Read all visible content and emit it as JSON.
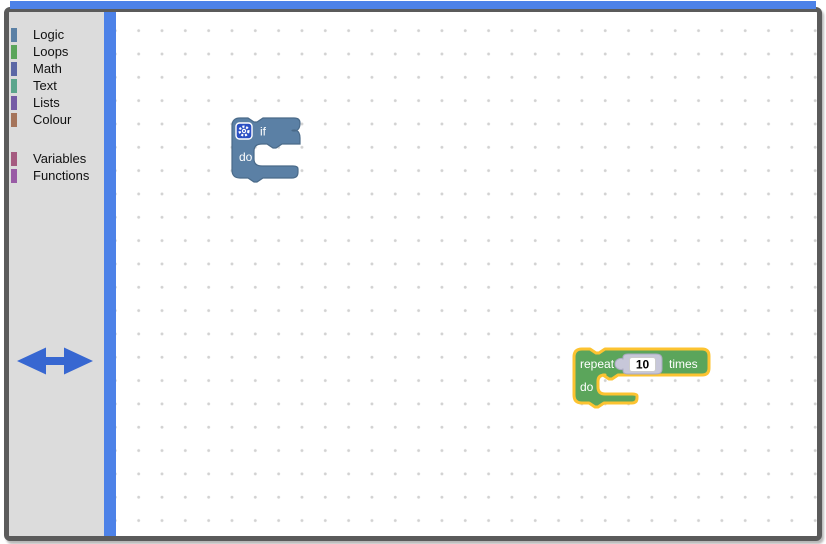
{
  "chrome": {
    "accent_blue": "#4d82e8",
    "frame_color": "#5b5b5b",
    "toolbox_bg": "#dcdcdc"
  },
  "toolbox": {
    "groups": [
      {
        "items": [
          {
            "label": "Logic",
            "color": "#5b80a5"
          },
          {
            "label": "Loops",
            "color": "#5ba55b"
          },
          {
            "label": "Math",
            "color": "#5b67a5"
          },
          {
            "label": "Text",
            "color": "#5ba58c"
          },
          {
            "label": "Lists",
            "color": "#745ba5"
          },
          {
            "label": "Colour",
            "color": "#a5745b"
          }
        ]
      },
      {
        "items": [
          {
            "label": "Variables",
            "color": "#a55b80"
          },
          {
            "label": "Functions",
            "color": "#995ba5"
          }
        ]
      }
    ]
  },
  "workspace": {
    "if_block": {
      "type": "controls_if",
      "label_if": "if",
      "label_do": "do",
      "color": "#5b80a5",
      "border_color": "#4a6a89",
      "gear_color": "#2b50c4"
    },
    "repeat_block": {
      "type": "controls_repeat",
      "label_repeat": "repeat",
      "label_times": "times",
      "label_do": "do",
      "value": "10",
      "color": "#5ba55b",
      "border_color": "#4a8a4a",
      "selected": true,
      "selection_color": "#fcc331",
      "shadow_color": "#c7c7d9",
      "shadow_border": "#a9a9c0",
      "field_bg": "#ffffff",
      "field_border": "#cccccc"
    },
    "cursor": {
      "type": "horizontal-resize-arrow",
      "color": "#3767d1"
    }
  }
}
